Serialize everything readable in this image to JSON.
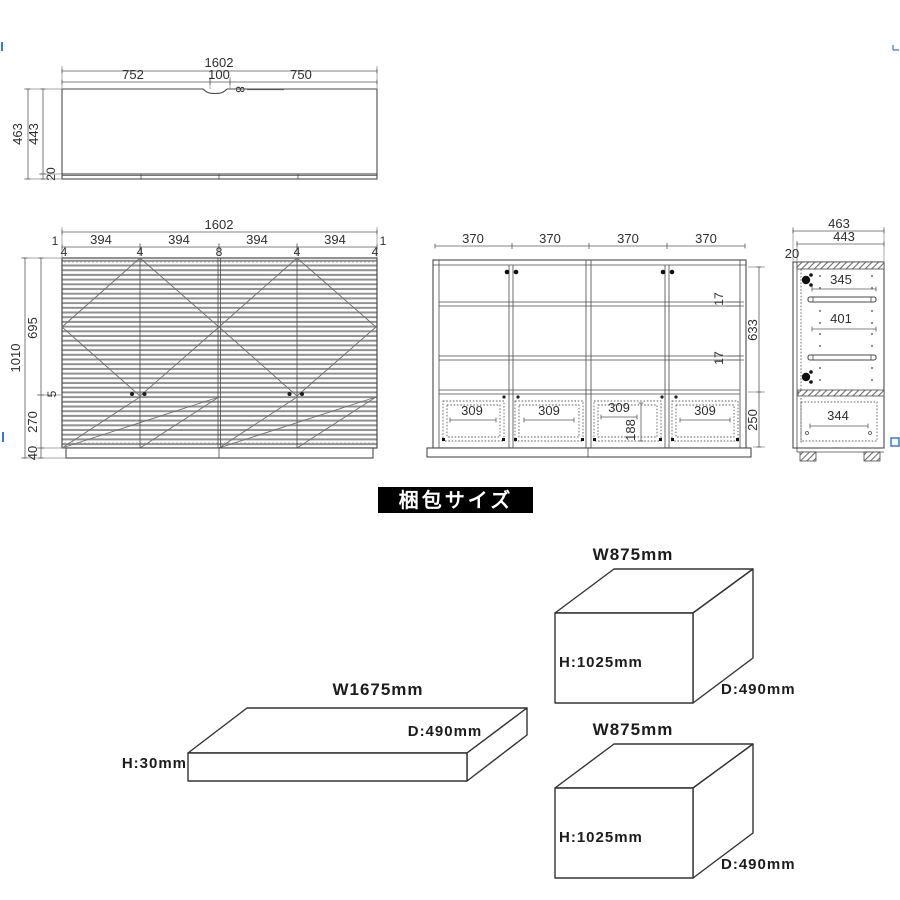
{
  "colors": {
    "line": "#4a4a4a",
    "dimension": "#5a5a5a",
    "louver": "#909090",
    "badge_bg": "#000000",
    "badge_text": "#ffffff",
    "artifact_blue": "#3578e5"
  },
  "top_view": {
    "w_total": "1602",
    "w_left": "752",
    "w_center": "100",
    "w_right": "750",
    "notch_depth": "8",
    "d_total": "463",
    "d_inner": "443",
    "edge": "20"
  },
  "front_view": {
    "w_total": "1602",
    "edge_left": "1",
    "edge_right": "1",
    "panels": [
      "394",
      "394",
      "394",
      "394"
    ],
    "gaps": [
      "4",
      "4",
      "8",
      "4",
      "4"
    ],
    "h_total": "1010",
    "h_upper": "695",
    "h_handle": "5",
    "h_lower": "270",
    "h_base": "40"
  },
  "inner_view": {
    "sections": [
      "370",
      "370",
      "370",
      "370"
    ],
    "shelf_t": [
      "17",
      "17"
    ],
    "h_inner": "633",
    "h_bottom": "250",
    "drawers": [
      "309",
      "309",
      "309",
      "309"
    ],
    "drawer_h": "188"
  },
  "side_view": {
    "d_total": "463",
    "d_inner": "443",
    "panel_t": "20",
    "gap_top": "345",
    "gap_mid": "401",
    "gap_bottom": "344"
  },
  "packing": {
    "badge": "梱包サイズ",
    "box_top": {
      "w": "W875mm",
      "h": "H:1025mm",
      "d": "D:490mm"
    },
    "box_flat": {
      "w": "W1675mm",
      "h": "H:30mm",
      "d": "D:490mm"
    },
    "box_bottom": {
      "w": "W875mm",
      "h": "H:1025mm",
      "d": "D:490mm"
    }
  }
}
